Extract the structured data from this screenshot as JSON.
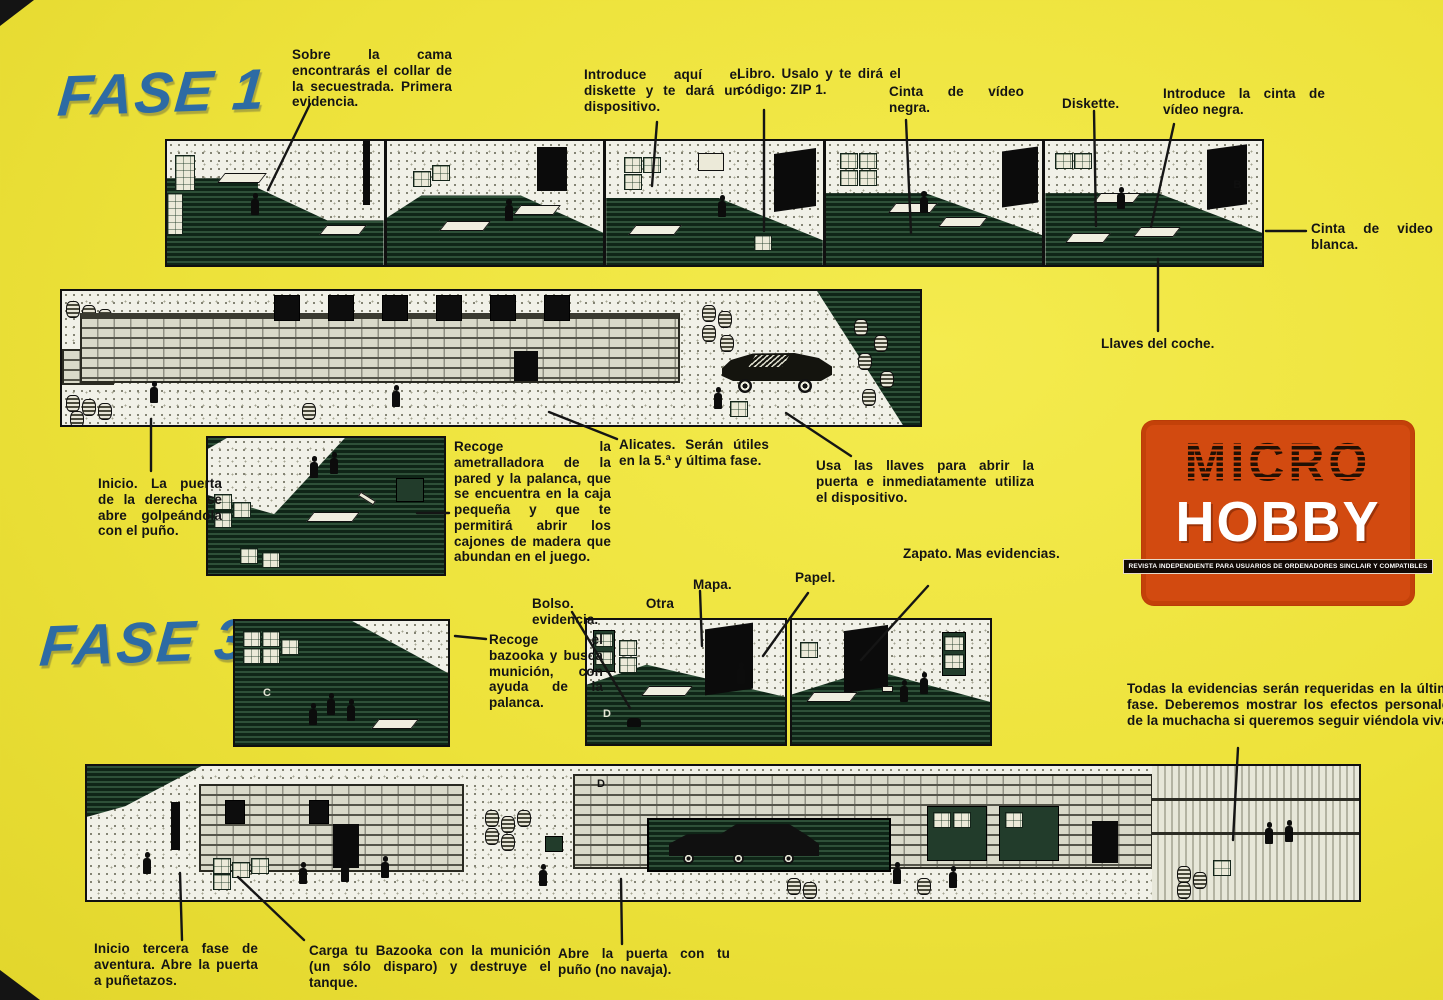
{
  "titles": {
    "fase1": "FASE 1",
    "fase3": "FASE 3"
  },
  "logo": {
    "micro": "MICRO",
    "hobby": "HOBBY",
    "tagline": "REVISTA INDEPENDIENTE PARA USUARIOS DE ORDENADORES SINCLAIR Y COMPATIBLES",
    "bg_color": "#d24a10"
  },
  "colors": {
    "page_yellow": "#ede23a",
    "title_blue": "#2d6ba4",
    "ink": "#141414",
    "game_green": "#0f2517"
  },
  "glyphs": {
    "room5_letter": "B",
    "fase3a_letter": "C",
    "fase3b_letter": "D",
    "bottom_letter": "D"
  },
  "annotations": [
    {
      "id": "collar",
      "text": "Sobre la cama encontrarás el collar de la secuestrada. Primera evidencia."
    },
    {
      "id": "diskette-slot",
      "text": "Introduce aquí el diskette y te dará un dispositivo."
    },
    {
      "id": "libro",
      "text": "Libro. Usalo y te dirá el código: ZIP 1."
    },
    {
      "id": "cinta-negra",
      "text": "Cinta de vídeo negra."
    },
    {
      "id": "diskette",
      "text": "Diskette."
    },
    {
      "id": "introduce-cinta",
      "text": "Introduce la cinta de vídeo negra."
    },
    {
      "id": "cinta-blanca",
      "text": "Cinta de video blanca."
    },
    {
      "id": "llaves",
      "text": "Llaves del coche."
    },
    {
      "id": "inicio-fase1",
      "text": "Inicio. La puerta de la derecha se abre golpeándola con el puño."
    },
    {
      "id": "ametralladora",
      "text": "Recoge la ametralladora de la pared y la palanca, que se encuentra en la caja pequeña y que te permitirá abrir los cajones de madera que abundan en el juego."
    },
    {
      "id": "alicates",
      "text": "Alicates. Serán útiles en la 5.ª y última fase."
    },
    {
      "id": "usa-llaves",
      "text": "Usa las llaves para abrir la puerta e inmediatamente utiliza el dispositivo."
    },
    {
      "id": "bolso",
      "text": "Bolso. Otra evidencia."
    },
    {
      "id": "mapa",
      "text": "Mapa."
    },
    {
      "id": "papel",
      "text": "Papel."
    },
    {
      "id": "zapato",
      "text": "Zapato. Mas evidencias."
    },
    {
      "id": "bazooka",
      "text": "Recoge el bazooka y busca munición, con ayuda de la palanca."
    },
    {
      "id": "evidencias",
      "text": "Todas la evidencias serán requeridas en la última fase. Deberemos mostrar los efectos personales de la muchacha si queremos seguir viéndola viva."
    },
    {
      "id": "inicio-fase3",
      "text": "Inicio tercera fase de aventura. Abre la puerta a puñetazos."
    },
    {
      "id": "carga-bazooka",
      "text": "Carga tu Bazooka con la munición (un sólo disparo) y destruye el tanque."
    },
    {
      "id": "abre-puerta",
      "text": "Abre la puerta con tu puño (no navaja)."
    }
  ]
}
